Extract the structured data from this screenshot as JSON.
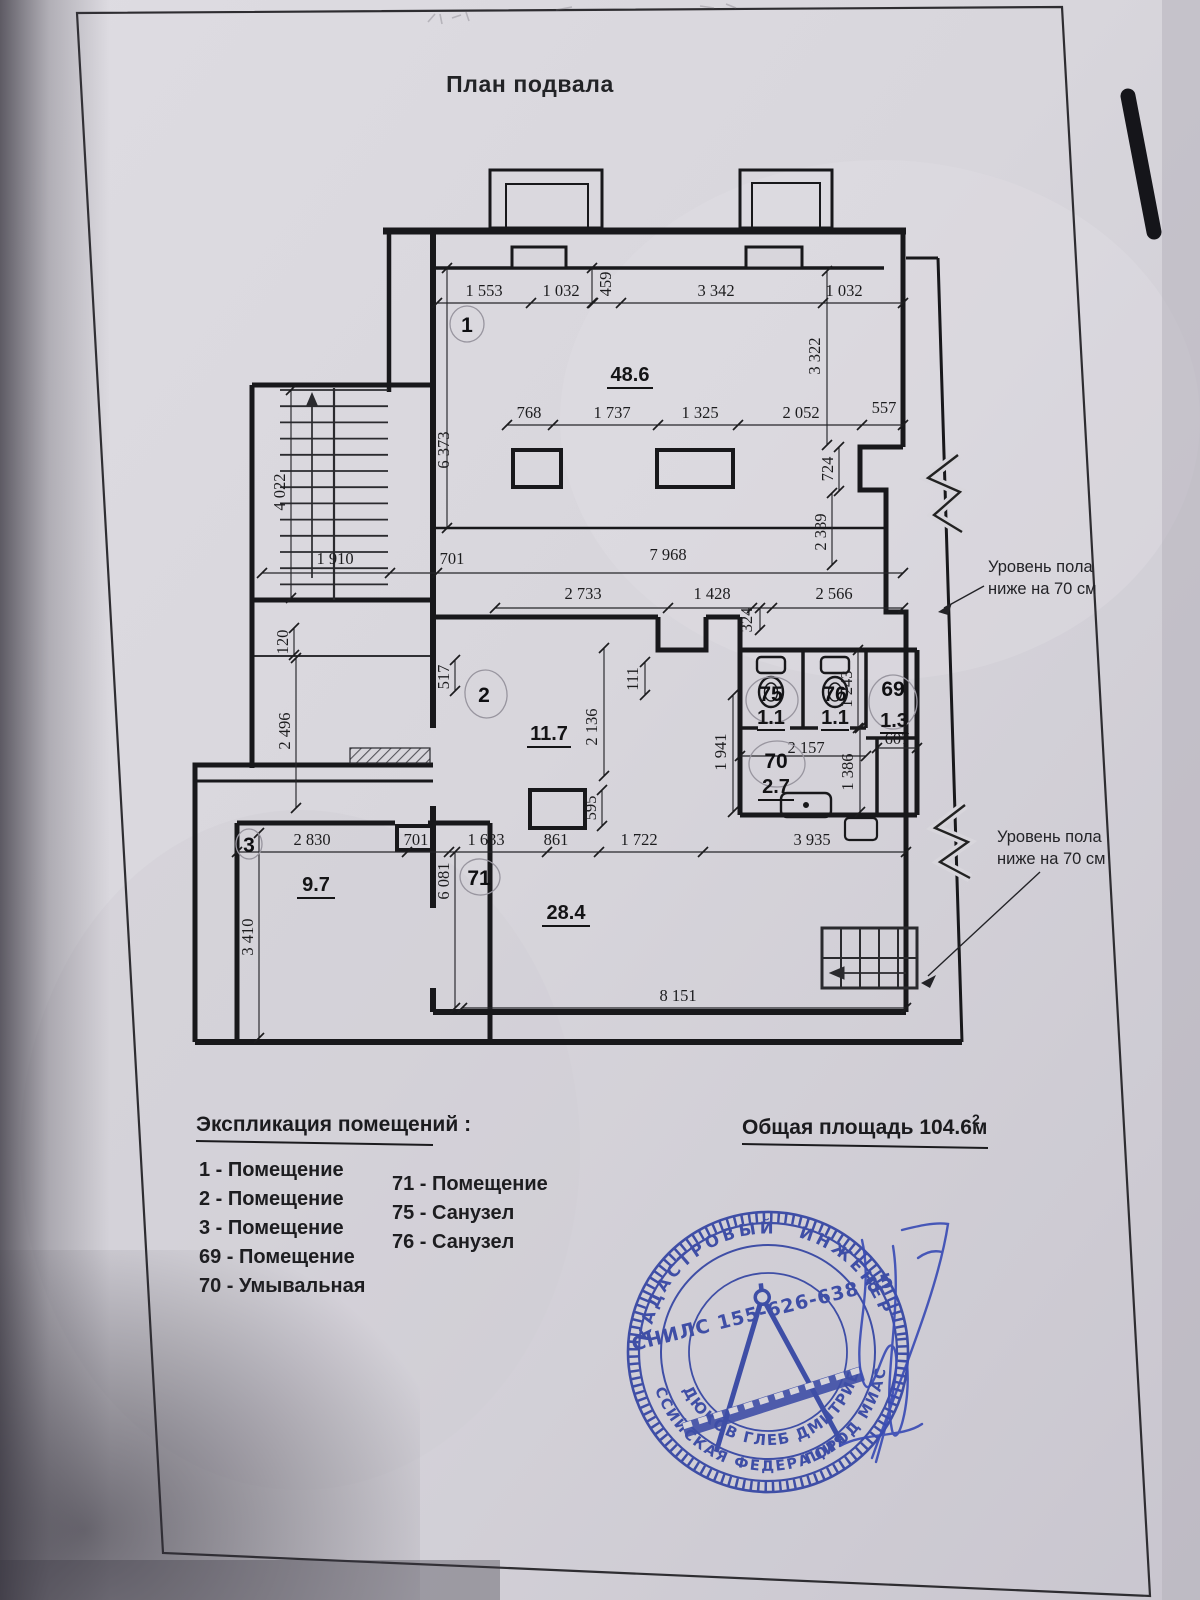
{
  "title": "План подвала",
  "colors": {
    "paper": "#d8d6dc",
    "ink": "#1a1a1c",
    "stamp_blue": "#2b3da0",
    "pen_blue": "#3b4db5"
  },
  "plan": {
    "dims": {
      "row_top": [
        "1 553",
        "1 032",
        "459",
        "3 342",
        "1 032"
      ],
      "row_room1": [
        "768",
        "1 737",
        "1 325",
        "2 052",
        "557"
      ],
      "col_right": [
        "3 322",
        "724",
        "2 339"
      ],
      "col_left": [
        "6 373",
        "4 022",
        "120",
        "2 496",
        "517",
        "3 410",
        "6 081"
      ],
      "row_mid": [
        "1 910",
        "701",
        "7 968"
      ],
      "row_mid2": [
        "2 733",
        "1 428",
        "324",
        "2 566"
      ],
      "col_mid": [
        "111",
        "2 136",
        "595",
        "1 941",
        "1 243",
        "1 386"
      ],
      "wc": [
        "2 157",
        "607"
      ],
      "row_low": [
        "2 830",
        "701",
        "1 633",
        "861",
        "1 722",
        "3 935"
      ],
      "row_bottom": [
        "8 151"
      ]
    },
    "rooms": {
      "r1": {
        "num": "1",
        "area": "48.6"
      },
      "r2": {
        "num": "2",
        "area": "11.7"
      },
      "r3": {
        "num": "3",
        "area": "9.7"
      },
      "r69": {
        "num": "69",
        "area": "1.3"
      },
      "r70": {
        "num": "70",
        "area": "2.7"
      },
      "r71": {
        "num": "71",
        "area": "28.4"
      },
      "r75": {
        "num": "75",
        "area": "1.1"
      },
      "r76": {
        "num": "76",
        "area": "1.1"
      }
    },
    "notes": {
      "floor_line1": "Уровень пола",
      "floor_line2": "ниже на 70 см"
    }
  },
  "legend": {
    "heading": "Экспликация помещений :",
    "col1": [
      "1 - Помещение",
      "2 - Помещение",
      "3 - Помещение",
      "69 - Помещение",
      "70 - Умывальная"
    ],
    "col2": [
      "71 - Помещение",
      "75 - Санузел",
      "76 - Санузел"
    ],
    "total_label": "Общая площадь 104.6м",
    "total_sup": "2"
  },
  "stamp": {
    "arc_top": "КАДАСТРОВЫЙ ИНЖЕНЕР",
    "snils": "СНИЛС 155-626-638 85",
    "name": "КУРДЮКОВ ГЛЕБ ДМИТРИЕВИЧ",
    "arc_bottom": "РОССИЙСКАЯ ФЕДЕРАЦИЯ",
    "arc_bottom2": "ГОРОД МИАСС"
  }
}
